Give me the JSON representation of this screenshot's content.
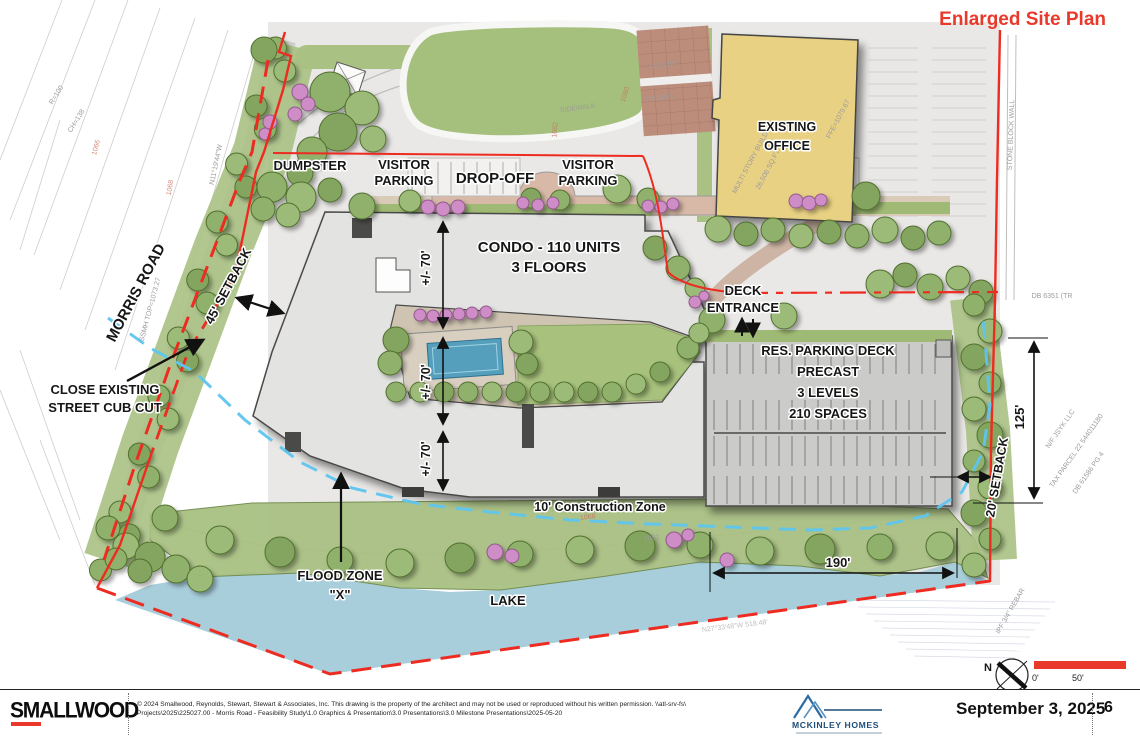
{
  "header": {
    "title": "Enlarged Site Plan"
  },
  "plan": {
    "roads": {
      "morris_road": "MORRIS ROAD"
    },
    "buildings": {
      "condo_line1": "CONDO - 110 UNITS",
      "condo_line2": "3 FLOORS",
      "office_line1": "EXISTING",
      "office_line2": "OFFICE",
      "deck_line1": "RES. PARKING DECK",
      "deck_line2": "PRECAST",
      "deck_line3": "3 LEVELS",
      "deck_line4": "210 SPACES"
    },
    "areas": {
      "dumpster": "DUMPSTER",
      "visitor_parking_left_line1": "VISITOR",
      "visitor_parking_left_line2": "PARKING",
      "drop_off": "DROP-OFF",
      "visitor_parking_right_line1": "VISITOR",
      "visitor_parking_right_line2": "PARKING",
      "pavers_1": "PAVERS",
      "pavers_2": "PAVERS",
      "lake": "LAKE",
      "flood_zone_line1": "FLOOD ZONE",
      "flood_zone_line2": "\"X\"",
      "construction_zone": "10' Construction Zone"
    },
    "annotations": {
      "deck_entrance_line1": "DECK",
      "deck_entrance_line2": "ENTRANCE",
      "close_curb_line1": "CLOSE EXISTING",
      "close_curb_line2": "STREET CUB CUT"
    },
    "dimensions": {
      "setback_45": "45' SETBACK",
      "setback_20": "20' SETBACK",
      "dim_70_top": "+/- 70'",
      "dim_70_mid": "+/- 70'",
      "dim_70_bottom": "+/- 70'",
      "dim_125": "125'",
      "dim_190": "190'"
    },
    "survey": {
      "curve_r": "R=100",
      "curve_ch": "CH=138",
      "bearing_left": "N11°19'44\"W",
      "ssmh": "SSMH TOP=1073.27",
      "contour_1066": "1066",
      "contour_1068": "1068",
      "contour_1082": "1082",
      "contour_1080": "1080",
      "contour_1068b": "1068",
      "contour_1052": "1052",
      "sidewalk": "SIDEWALK",
      "stone_wall": "STONE BLOCK WALL",
      "db_6351": "DB 6351 (TR",
      "nf_1": "N/F  JSYK LLC",
      "nf_2": "TAX PARCEL 22 544011180",
      "nf_3": "DB 61586 PG 4",
      "ipf": "IPF 3/4\" REBAR",
      "bearing_bottom": "N27°33'48\"W   518.48'",
      "office_faint_1": "MULTI STORY BUILDING",
      "office_faint_2": "26,508 SQ.FT.",
      "office_faint_3": "FFE=1079.67"
    },
    "compass": {
      "north": "N",
      "scale_zero": "0'",
      "scale_fifty": "50'"
    }
  },
  "footer": {
    "smallwood_logo": "SMALLWOOD",
    "copyright_line1": "© 2024 Smallwood, Reynolds, Stewart, Stewart & Associates, Inc. This drawing is the property of the architect and may not be used or reproduced without his written permission. \\\\atl-srv-fs\\",
    "copyright_line2": "Projects\\2025\\225027.00 - Morris Road - Feasibility Study\\1.0 Graphics & Presentation\\3.0 Presentations\\3.0 Milestone Presentations\\2025-05-20",
    "mckinley_name": "MCKINLEY HOMES",
    "date": "September 3, 2025",
    "page_number": "6"
  },
  "colors": {
    "accent_red": "#e8392a",
    "boundary_red": "#ee2b20",
    "flood_blue": "#5ec5ef",
    "lake_blue": "#a8cedb",
    "buffer_green": "#a9c183",
    "tree_green": "#8fb06a",
    "shrub_pink": "#cf8dc7",
    "building_gray": "#e3e3e1",
    "deck_gray": "#cbcbc9",
    "office_yellow": "#e9d183",
    "dropoff_tan": "#d8b9a8",
    "paver_brown": "#bd8d7c",
    "pool_blue": "#569fbc",
    "mckinley_navy": "#1d4e79"
  }
}
